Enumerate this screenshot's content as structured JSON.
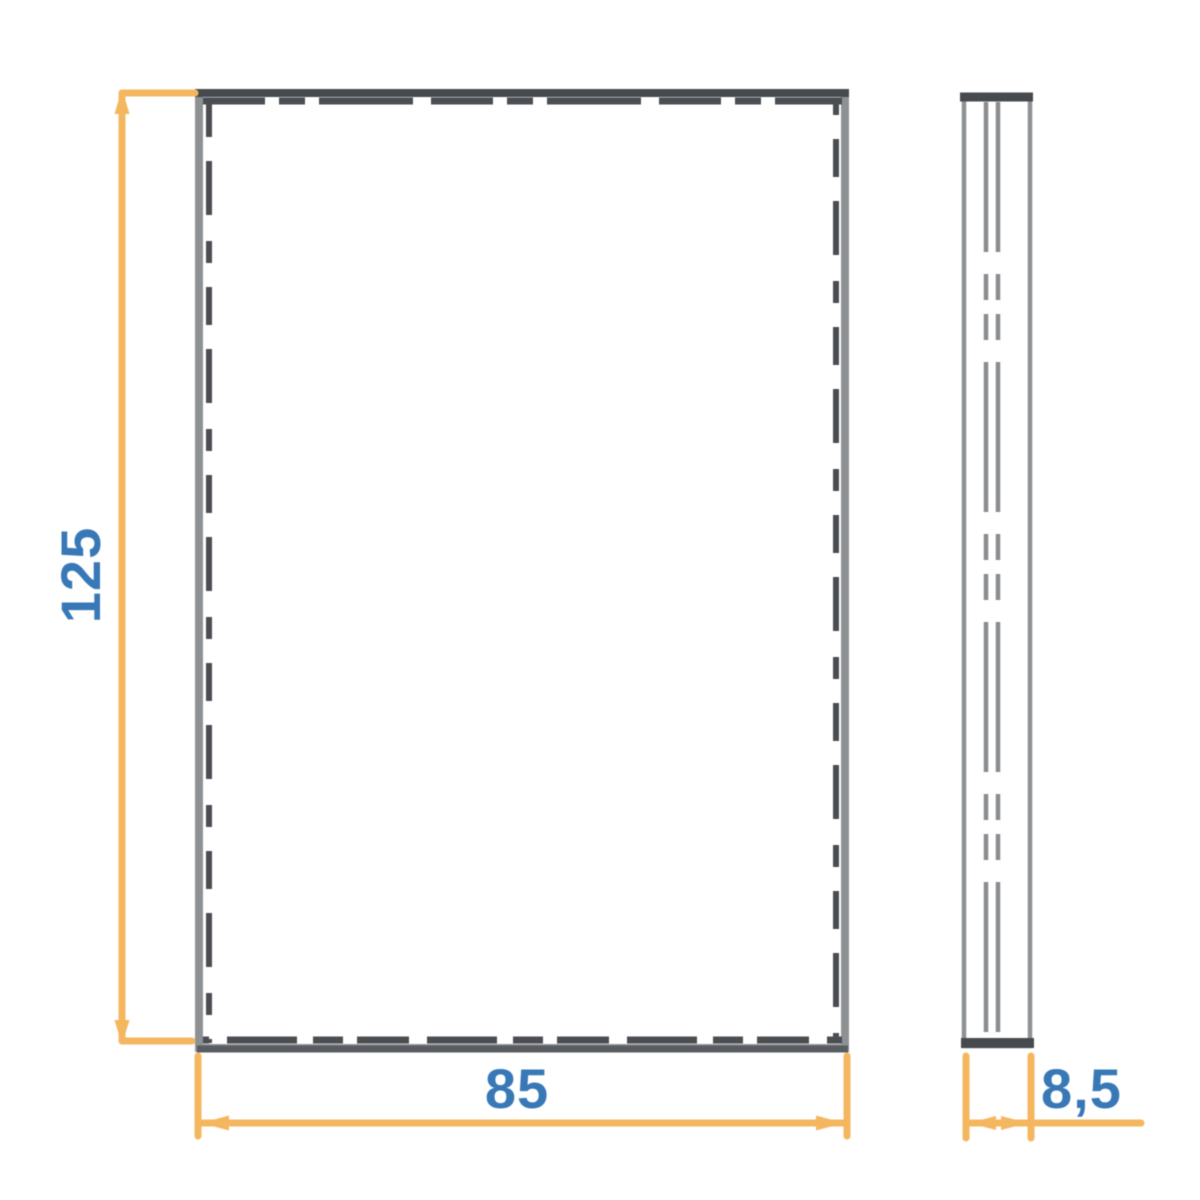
{
  "drawing": {
    "kind": "technical-dimension-drawing",
    "views": {
      "front": {
        "name": "front-view"
      },
      "side": {
        "name": "side-view"
      }
    },
    "dimensions": {
      "height": {
        "label": "125"
      },
      "width": {
        "label": "85"
      },
      "depth": {
        "label": "8,5"
      }
    },
    "colors": {
      "background": "#FFFFFF",
      "dimension_line": "#F4B75F",
      "dimension_text": "#3878B6",
      "outline_light": "#8E9194",
      "outline_mid": "#595D61",
      "outline_dark": "#464A4E",
      "hidden_line": "#4A4E52",
      "hidden_line_light": "#8A8D90"
    }
  }
}
